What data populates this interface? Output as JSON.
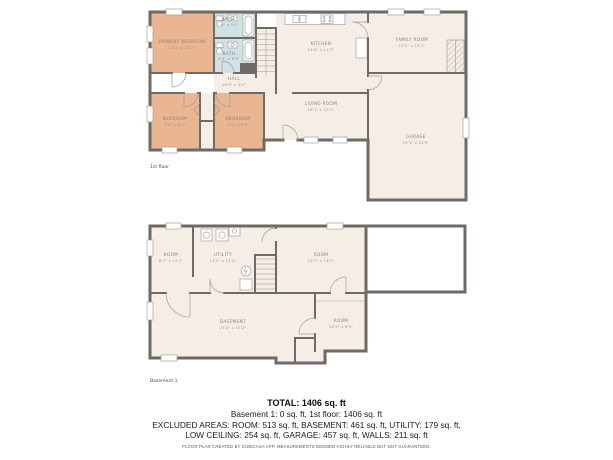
{
  "colors": {
    "wall": "#6e6a66",
    "room_default": "#f4eee7",
    "room_bedroom": "#eab591",
    "room_bath": "#cfe2e5",
    "background": "#ffffff",
    "label_text": "#8b8176"
  },
  "floor1": {
    "floor_label": "1st floor",
    "rooms": [
      {
        "name": "PRIMARY BEDROOM",
        "dims": "13'1\" x 11'1\""
      },
      {
        "name": "BATH",
        "dims": "7'4\" x 5'2\""
      },
      {
        "name": "BATH",
        "dims": "8'4\" x 6'9\""
      },
      {
        "name": "HALL",
        "dims": "16'3\" x 3'0\""
      },
      {
        "name": "BEDROOM",
        "dims": "9'9\" x 8'5\""
      },
      {
        "name": "BEDROOM",
        "dims": "9'1\" x 8'5\""
      },
      {
        "name": "KITCHEN",
        "dims": "13'4\" x 11'7\""
      },
      {
        "name": "FAMILY ROOM",
        "dims": "19'2\" x 13'1\""
      },
      {
        "name": "LIVING ROOM",
        "dims": "16'1\" x 12'1\""
      },
      {
        "name": "GARAGE",
        "dims": "19'1\" x 20'9\""
      }
    ]
  },
  "basement": {
    "floor_label": "Basement 1",
    "rooms": [
      {
        "name": "ROOM",
        "dims": "8'7\" x 12'7\""
      },
      {
        "name": "UTILITY",
        "dims": "13'2\" x 13'2\""
      },
      {
        "name": "ROOM",
        "dims": "18'7\" x 13'1\""
      },
      {
        "name": "BASEMENT",
        "dims": "27'2\" x 15'2\""
      },
      {
        "name": "ROOM",
        "dims": "10'2\" x 9'9\""
      }
    ]
  },
  "summary": {
    "total": "TOTAL: 1406 sq. ft",
    "line1": "Basement 1: 0 sq. ft, 1st floor: 1406 sq. ft",
    "line2": "EXCLUDED AREAS: ROOM: 513 sq. ft, BASEMENT: 461 sq. ft, UTILITY: 179 sq. ft,",
    "line3": "LOW CEILING: 254 sq. ft, GARAGE: 457 sq. ft, WALLS: 211 sq. ft",
    "disclaimer": "FLOOR PLAN CREATED BY CUBICASA APP. MEASUREMENTS DEEMED HIGHLY RELIABLE BUT NOT GUARANTEED."
  }
}
